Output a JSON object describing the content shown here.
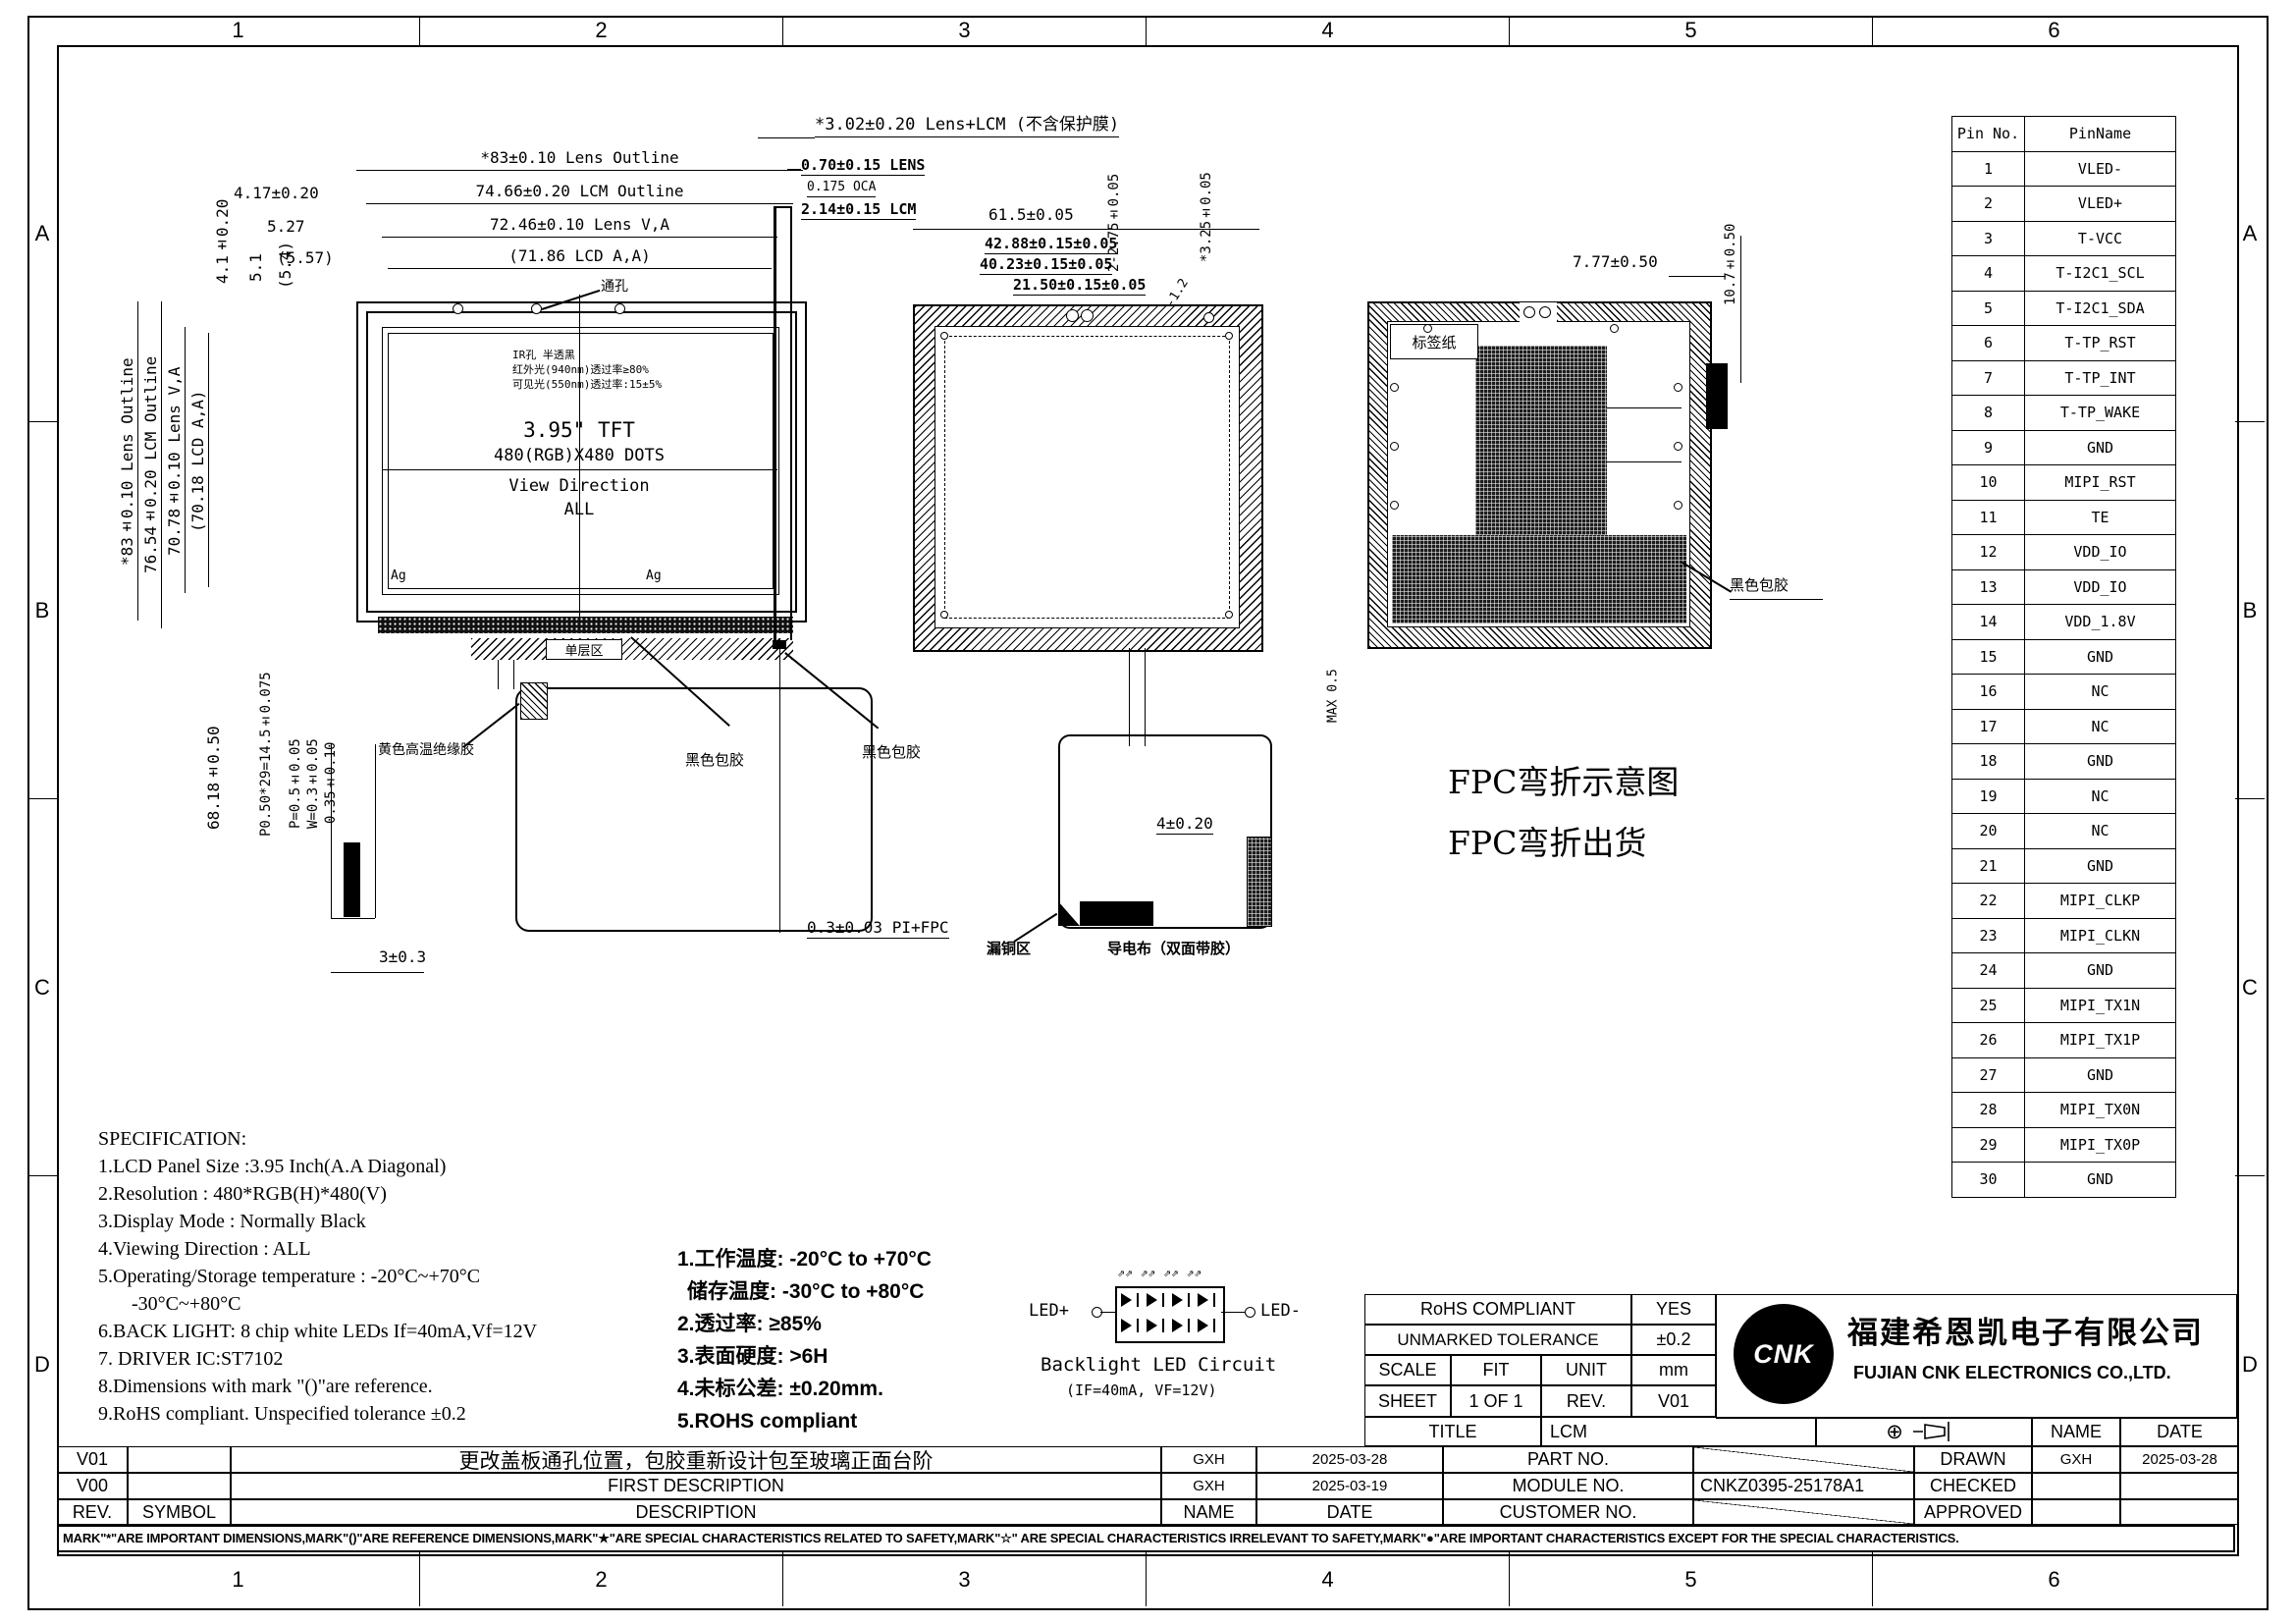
{
  "zones": {
    "cols": [
      "1",
      "2",
      "3",
      "4",
      "5",
      "6"
    ],
    "rows": [
      "A",
      "B",
      "C",
      "D"
    ]
  },
  "front_view": {
    "dim_lens_outline_h": "*83±0.10 Lens Outline",
    "dim_lcm_outline_h": "74.66±0.20 LCM Outline",
    "dim_lens_va_h": "72.46±0.10 Lens V,A",
    "dim_lcd_aa_h": "(71.86 LCD A,A)",
    "dim_4_17": "4.17±0.20",
    "dim_5_27": "5.27",
    "dim_5_57": "(5.57)",
    "dim_lens_outline_v": "*83±0.10 Lens Outline",
    "dim_lcm_outline_v": "76.54±0.20 LCM Outline",
    "dim_lens_va_v": "70.78±0.10 Lens V,A",
    "dim_lcd_aa_v": "(70.18 LCD A,A)",
    "dim_4_1": "4.1±0.20",
    "dim_5_1": "5.1",
    "dim_5_4": "(5.4)",
    "hole_label": "通孔",
    "ir_note_1": "IR孔 半透黑",
    "ir_note_2": "红外光(940nm)透过率≥80%",
    "ir_note_3": "可见光(550nm)透过率:15±5%",
    "panel_size": "3.95\" TFT",
    "panel_res": "480(RGB)X480 DOTS",
    "view_dir_1": "View Direction",
    "view_dir_2": "ALL",
    "ag_left": "Ag",
    "ag_right": "Ag",
    "single_layer_label": "单层区",
    "yellow_tape_label": "黄色高温绝缘胶",
    "black_glue_label": "黑色包胶",
    "dim_fpc_height": "68.18±0.50",
    "dim_pitch": "P0.50*29=14.5±0.075",
    "dim_p": "P=0.5±0.05",
    "dim_w": "W=0.3±0.05",
    "dim_t": "0.35±0.10",
    "dim_3": "3±0.3"
  },
  "side_view": {
    "dim_total": "*3.02±0.20 Lens+LCM (不含保护膜)",
    "dim_lens": "0.70±0.15 LENS",
    "dim_oca": "0.175 OCA",
    "dim_lcm": "2.14±0.15 LCM",
    "black_glue_label": "黑色包胶",
    "dim_pi_fpc": "0.3±0.03 PI+FPC"
  },
  "cover_view": {
    "dim_61_5": "61.5±0.05",
    "dim_42_88": "42.88±0.15±0.05",
    "dim_40_23": "40.23±0.15±0.05",
    "dim_21_50": "21.50±0.15±0.05",
    "dim_2_2_75": "2-2.75±0.05",
    "dim_3_25": "*3.25±0.05",
    "dim_2_1_5": "2-1.5",
    "dim_2_1_2": "2-1.2",
    "dim_4": "4±0.20",
    "copper_label": "漏铜区",
    "tape_label": "导电布（双面带胶）"
  },
  "back_view": {
    "dim_7_77": "7.77±0.50",
    "dim_10_7": "10.7±0.50",
    "label_paper": "标签纸",
    "black_glue_label": "黑色包胶",
    "dim_max": "MAX 0.5",
    "fpc_note_1": "FPC弯折示意图",
    "fpc_note_2": "FPC弯折出货"
  },
  "pin_table": {
    "headers": [
      "Pin No.",
      "PinName"
    ],
    "rows": [
      [
        "1",
        "VLED-"
      ],
      [
        "2",
        "VLED+"
      ],
      [
        "3",
        "T-VCC"
      ],
      [
        "4",
        "T-I2C1_SCL"
      ],
      [
        "5",
        "T-I2C1_SDA"
      ],
      [
        "6",
        "T-TP_RST"
      ],
      [
        "7",
        "T-TP_INT"
      ],
      [
        "8",
        "T-TP_WAKE"
      ],
      [
        "9",
        "GND"
      ],
      [
        "10",
        "MIPI_RST"
      ],
      [
        "11",
        "TE"
      ],
      [
        "12",
        "VDD_IO"
      ],
      [
        "13",
        "VDD_IO"
      ],
      [
        "14",
        "VDD_1.8V"
      ],
      [
        "15",
        "GND"
      ],
      [
        "16",
        "NC"
      ],
      [
        "17",
        "NC"
      ],
      [
        "18",
        "GND"
      ],
      [
        "19",
        "NC"
      ],
      [
        "20",
        "NC"
      ],
      [
        "21",
        "GND"
      ],
      [
        "22",
        "MIPI_CLKP"
      ],
      [
        "23",
        "MIPI_CLKN"
      ],
      [
        "24",
        "GND"
      ],
      [
        "25",
        "MIPI_TX1N"
      ],
      [
        "26",
        "MIPI_TX1P"
      ],
      [
        "27",
        "GND"
      ],
      [
        "28",
        "MIPI_TX0N"
      ],
      [
        "29",
        "MIPI_TX0P"
      ],
      [
        "30",
        "GND"
      ]
    ]
  },
  "specification": {
    "title": "SPECIFICATION:",
    "lines": [
      "1.LCD Panel Size :3.95 Inch(A.A Diagonal)",
      "2.Resolution : 480*RGB(H)*480(V)",
      "3.Display Mode : Normally Black",
      "4.Viewing Direction : ALL",
      "5.Operating/Storage temperature : -20°C~+70°C",
      "-30°C~+80°C",
      "6.BACK LIGHT: 8 chip white LEDs If=40mA,Vf=12V",
      "7. DRIVER IC:ST7102",
      "8.Dimensions with mark \"()\"are reference.",
      "9.RoHS compliant. Unspecified tolerance ±0.2"
    ]
  },
  "notes_cn": {
    "lines": [
      "1.工作温度: -20°C to +70°C",
      "储存温度: -30°C to +80°C",
      "2.透过率: ≥85%",
      "3.表面硬度: >6H",
      "4.未标公差: ±0.20mm.",
      "5.ROHS compliant"
    ]
  },
  "led_circuit": {
    "plus": "LED+",
    "minus": "LED-",
    "arrows": "⇗⇗  ⇗⇗  ⇗⇗  ⇗⇗",
    "caption": "Backlight LED Circuit",
    "subcaption": "(IF=40mA, VF=12V)"
  },
  "title_block": {
    "rohs_label": "RoHS COMPLIANT",
    "rohs_value": "YES",
    "tolerance_label": "UNMARKED TOLERANCE",
    "tolerance_value": "±0.2",
    "scale_label": "SCALE",
    "scale_value": "FIT",
    "unit_label": "UNIT",
    "unit_value": "mm",
    "sheet_label": "SHEET",
    "sheet_value": "1 OF 1",
    "rev_label": "REV.",
    "rev_value": "V01",
    "title_label": "TITLE",
    "title_value": "LCM",
    "logo_text": "CNK",
    "company_cn": "福建希恩凯电子有限公司",
    "company_en": "FUJIAN CNK ELECTRONICS CO.,LTD.",
    "part_no_label": "PART NO.",
    "module_no_label": "MODULE NO.",
    "module_no_value": "CNKZ0395-25178A1",
    "customer_no_label": "CUSTOMER NO.",
    "drawn_label": "DRAWN",
    "drawn_name": "GXH",
    "drawn_date": "2025-03-28",
    "checked_label": "CHECKED",
    "approved_label": "APPROVED",
    "name_header": "NAME",
    "date_header": "DATE"
  },
  "revision_table": {
    "rows": [
      {
        "rev": "V01",
        "symbol": "",
        "desc": "更改盖板通孔位置，包胶重新设计包至玻璃正面台阶",
        "name": "GXH",
        "date": "2025-03-28"
      },
      {
        "rev": "V00",
        "symbol": "",
        "desc": "FIRST  DESCRIPTION",
        "name": "GXH",
        "date": "2025-03-19"
      },
      {
        "rev": "REV.",
        "symbol": "SYMBOL",
        "desc": "DESCRIPTION",
        "name": "NAME",
        "date": "DATE"
      }
    ]
  },
  "disclaimer": "MARK\"*\"ARE IMPORTANT DIMENSIONS,MARK\"()\"ARE REFERENCE DIMENSIONS,MARK\"★\"ARE SPECIAL CHARACTERISTICS RELATED TO SAFETY,MARK\"☆\" ARE SPECIAL CHARACTERISTICS IRRELEVANT TO SAFETY,MARK\"●\"ARE IMPORTANT CHARACTERISTICS EXCEPT FOR THE SPECIAL CHARACTERISTICS."
}
